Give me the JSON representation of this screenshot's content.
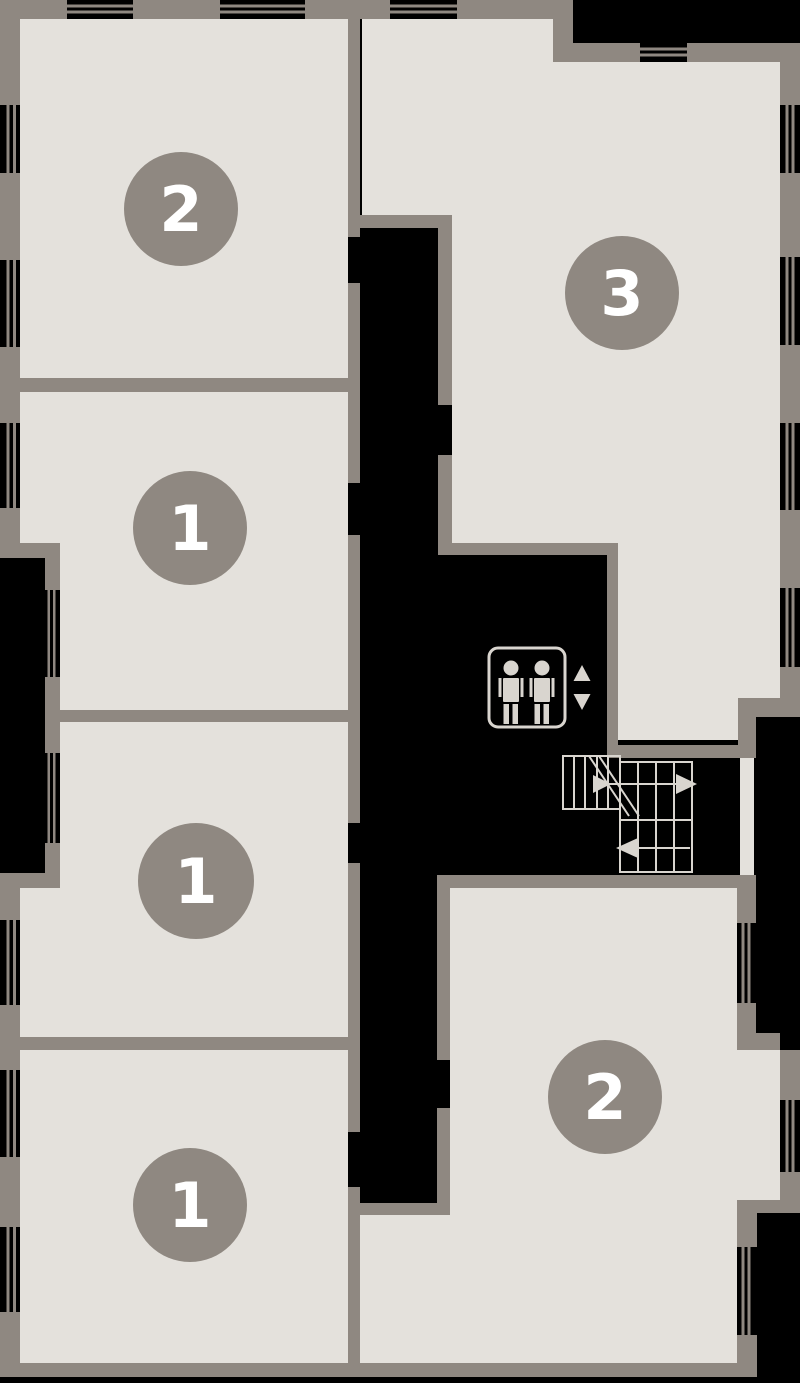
{
  "floor_plan": {
    "colors": {
      "background": "#000000",
      "walls": "#8F8881",
      "room_fill": "#E4E1DC",
      "symbols": "#D9D5CF",
      "badge_fill": "#8F8881",
      "badge_text": "#FFFFFF"
    },
    "units": [
      {
        "name": "unit-top-left",
        "label": "2"
      },
      {
        "name": "unit-top-right",
        "label": "3"
      },
      {
        "name": "unit-left-upper",
        "label": "1"
      },
      {
        "name": "unit-left-middle",
        "label": "1"
      },
      {
        "name": "unit-left-lower",
        "label": "1"
      },
      {
        "name": "unit-bottom-right",
        "label": "2"
      }
    ],
    "icons": [
      "elevator-icon",
      "elevator-up-arrow-icon",
      "elevator-down-arrow-icon",
      "stairs-icon",
      "stairs-arrow-right-icon",
      "stairs-arrow-left-icon"
    ]
  }
}
